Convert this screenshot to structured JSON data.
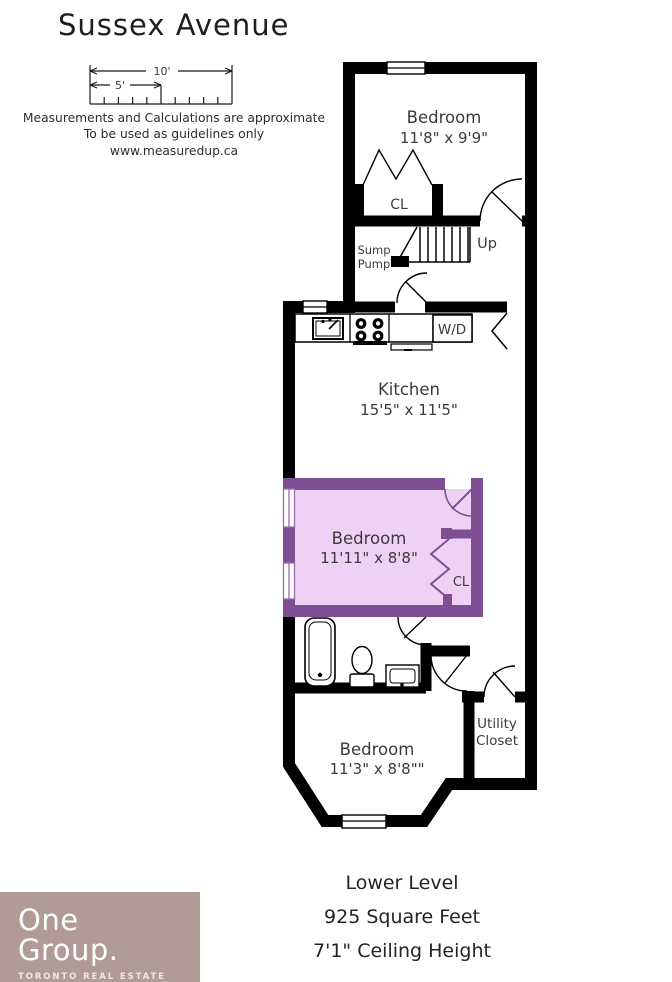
{
  "title": "Sussex Avenue",
  "scale_bar": {
    "label_10": "10'",
    "label_5": "5'"
  },
  "disclaimer": {
    "line1": "Measurements and Calculations are approximate",
    "line2": "To be used as guidelines only",
    "line3": "www.measuredup.ca"
  },
  "rooms": {
    "bedroom_top": {
      "name": "Bedroom",
      "dims": "11'8\" x 9'9\""
    },
    "closet_top": {
      "label": "CL"
    },
    "sump": {
      "line1": "Sump",
      "line2": "Pump"
    },
    "stairs": {
      "label": "Up"
    },
    "laundry": {
      "label": "W/D"
    },
    "kitchen": {
      "name": "Kitchen",
      "dims": "15'5\" x 11'5\""
    },
    "bedroom_mid": {
      "name": "Bedroom",
      "dims": "11'11\" x 8'8\""
    },
    "closet_mid": {
      "label": "CL"
    },
    "utility_closet": {
      "line1": "Utility",
      "line2": "Closet"
    },
    "bedroom_bottom": {
      "name": "Bedroom",
      "dims": "11'3\" x 8'8\"\""
    }
  },
  "footer": {
    "line1": "Lower Level",
    "line2": "925 Square Feet",
    "line3": "7'1\" Ceiling Height"
  },
  "logo": {
    "line1": "One",
    "line2": "Group.",
    "line3": "TORONTO REAL ESTATE"
  },
  "colors": {
    "wall": "#000000",
    "purple_wall": "#7e4f92",
    "purple_fill": "#efd1f5",
    "purple_accent": "#9b6bb0",
    "logo_bg": "#b29a95"
  }
}
